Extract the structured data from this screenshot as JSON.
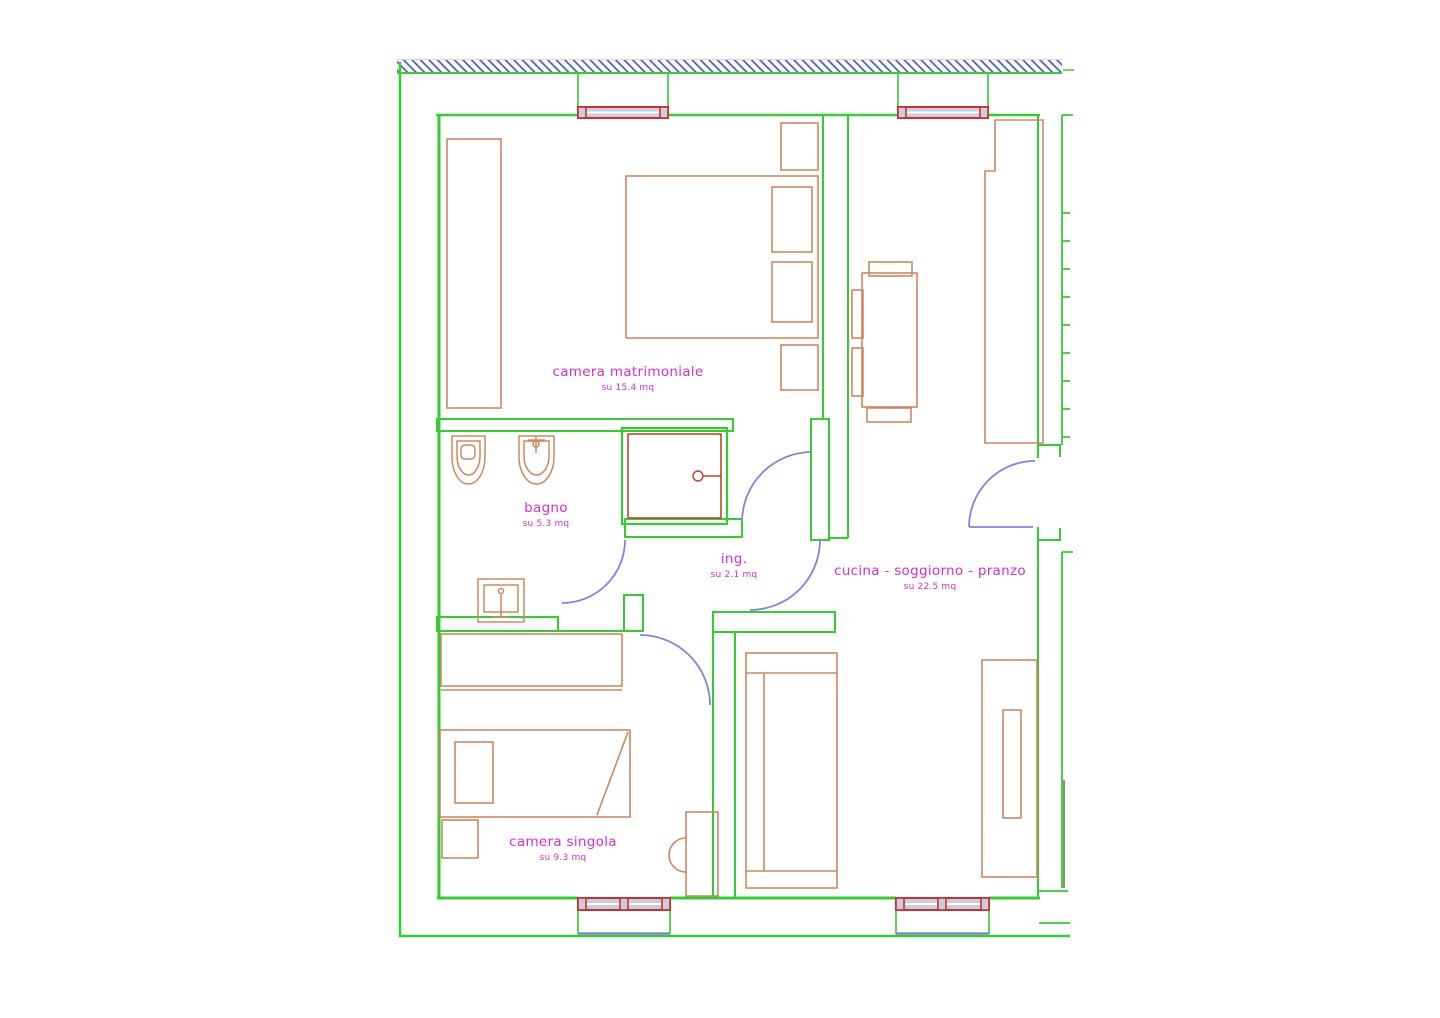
{
  "drawing": {
    "type": "apartment floor plan",
    "rooms": [
      {
        "id": "camera-matrimoniale",
        "label": "camera matrimoniale",
        "area": "su 15.4 mq"
      },
      {
        "id": "bagno",
        "label": "bagno",
        "area": "su 5.3 mq"
      },
      {
        "id": "ing",
        "label": "ing.",
        "area": "su 2.1 mq"
      },
      {
        "id": "cucina-soggiorno-pranzo",
        "label": "cucina - soggiorno - pranzo",
        "area": "su 22.5 mq"
      },
      {
        "id": "camera-singola",
        "label": "camera singola",
        "area": "su 9.3 mq"
      }
    ],
    "palette": {
      "wall_green": "#33cc33",
      "furniture_orange": "#cf8760",
      "fixture_red": "#c4432e",
      "window_red": "#cc2d2d",
      "window_glass": "#c7cfdf",
      "door_blue": "#8085d8",
      "sill_blue": "#7a7fd0",
      "hatch_blue": "#4a57b8",
      "label_magenta": "#d12fd1",
      "background": "#ffffff"
    }
  },
  "rooms": [
    {
      "label": "camera matrimoniale",
      "area": "su 15.4 mq"
    },
    {
      "label": "bagno",
      "area": "su 5.3 mq"
    },
    {
      "label": "ing.",
      "area": "su 2.1 mq"
    },
    {
      "label": "cucina - soggiorno - pranzo",
      "area": "su 22.5 mq"
    },
    {
      "label": "camera singola",
      "area": "su 9.3 mq"
    }
  ]
}
